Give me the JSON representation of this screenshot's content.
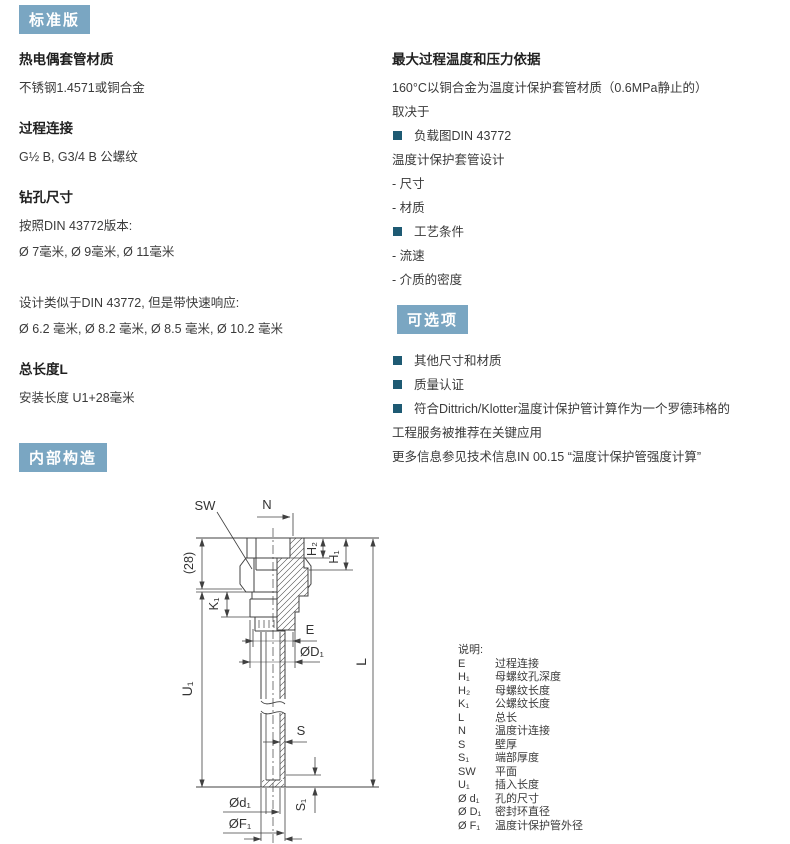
{
  "colors": {
    "badge_bg": "#7aa6c2",
    "bullet": "#1e5a73",
    "text": "#3a3a3a",
    "line": "#404040"
  },
  "badges": {
    "standard": "标准版",
    "options": "可选项",
    "internal": "内部构造"
  },
  "left": {
    "s1_heading": "热电偶套管材质",
    "s1_line1": "不锈钢1.4571或铜合金",
    "s2_heading": "过程连接",
    "s2_line1": "G½ B, G3/4 B 公螺纹",
    "s3_heading": "钻孔尺寸",
    "s3_line1": "按照DIN 43772版本:",
    "s3_line2": "Ø 7毫米, Ø 9毫米, Ø 11毫米",
    "s3_line3": "设计类似于DIN 43772, 但是带快速响应:",
    "s3_line4": "Ø 6.2 毫米, Ø 8.2 毫米, Ø 8.5 毫米, Ø 10.2 毫米",
    "s4_heading": "总长度L",
    "s4_line1": "安装长度 U1+28毫米"
  },
  "right": {
    "heading": "最大过程温度和压力依据",
    "line1": "160°C以铜合金为温度计保护套管材质（0.6MPa静止的）",
    "line2": "取决于",
    "b1": "负载图DIN 43772",
    "b1_sub": "温度计保护套管设计",
    "b1_i1": "- 尺寸",
    "b1_i2": "- 材质",
    "b2": "工艺条件",
    "b2_i1": "- 流速",
    "b2_i2": "- 介质的密度"
  },
  "options": {
    "b1": "其他尺寸和材质",
    "b2": "质量认证",
    "b3_line1": "符合Dittrich/Klotter温度计保护管计算作为一个罗德玮格的",
    "b3_line2": "工程服务被推荐在关键应用",
    "footnote": "更多信息参见技术信息IN 00.15 “温度计保护管强度计算”"
  },
  "diagram": {
    "labels": {
      "sw": "SW",
      "n": "N",
      "dim28": "(28)",
      "k1": "K₁",
      "u1": "U₁",
      "l": "L",
      "h2": "H₂",
      "h1": "H₁",
      "e": "E",
      "d_big": "ØD₁",
      "s": "S",
      "s1": "S₁",
      "d_small": "Ød₁",
      "f1": "ØF₁"
    }
  },
  "legend": {
    "title": "说明:",
    "rows": [
      {
        "sym": "E",
        "desc": "过程连接"
      },
      {
        "sym": "H₁",
        "desc": "母螺纹孔深度"
      },
      {
        "sym": "H₂",
        "desc": "母螺纹长度"
      },
      {
        "sym": "K₁",
        "desc": "公螺纹长度"
      },
      {
        "sym": "L",
        "desc": "总长"
      },
      {
        "sym": "N",
        "desc": "温度计连接"
      },
      {
        "sym": "S",
        "desc": "壁厚"
      },
      {
        "sym": "S₁",
        "desc": "端部厚度"
      },
      {
        "sym": "SW",
        "desc": "平面"
      },
      {
        "sym": "U₁",
        "desc": "插入长度"
      },
      {
        "sym": "Ø d₁",
        "desc": "孔的尺寸"
      },
      {
        "sym": "Ø D₁",
        "desc": "密封环直径"
      },
      {
        "sym": "Ø F₁",
        "desc": "温度计保护管外径"
      }
    ]
  }
}
